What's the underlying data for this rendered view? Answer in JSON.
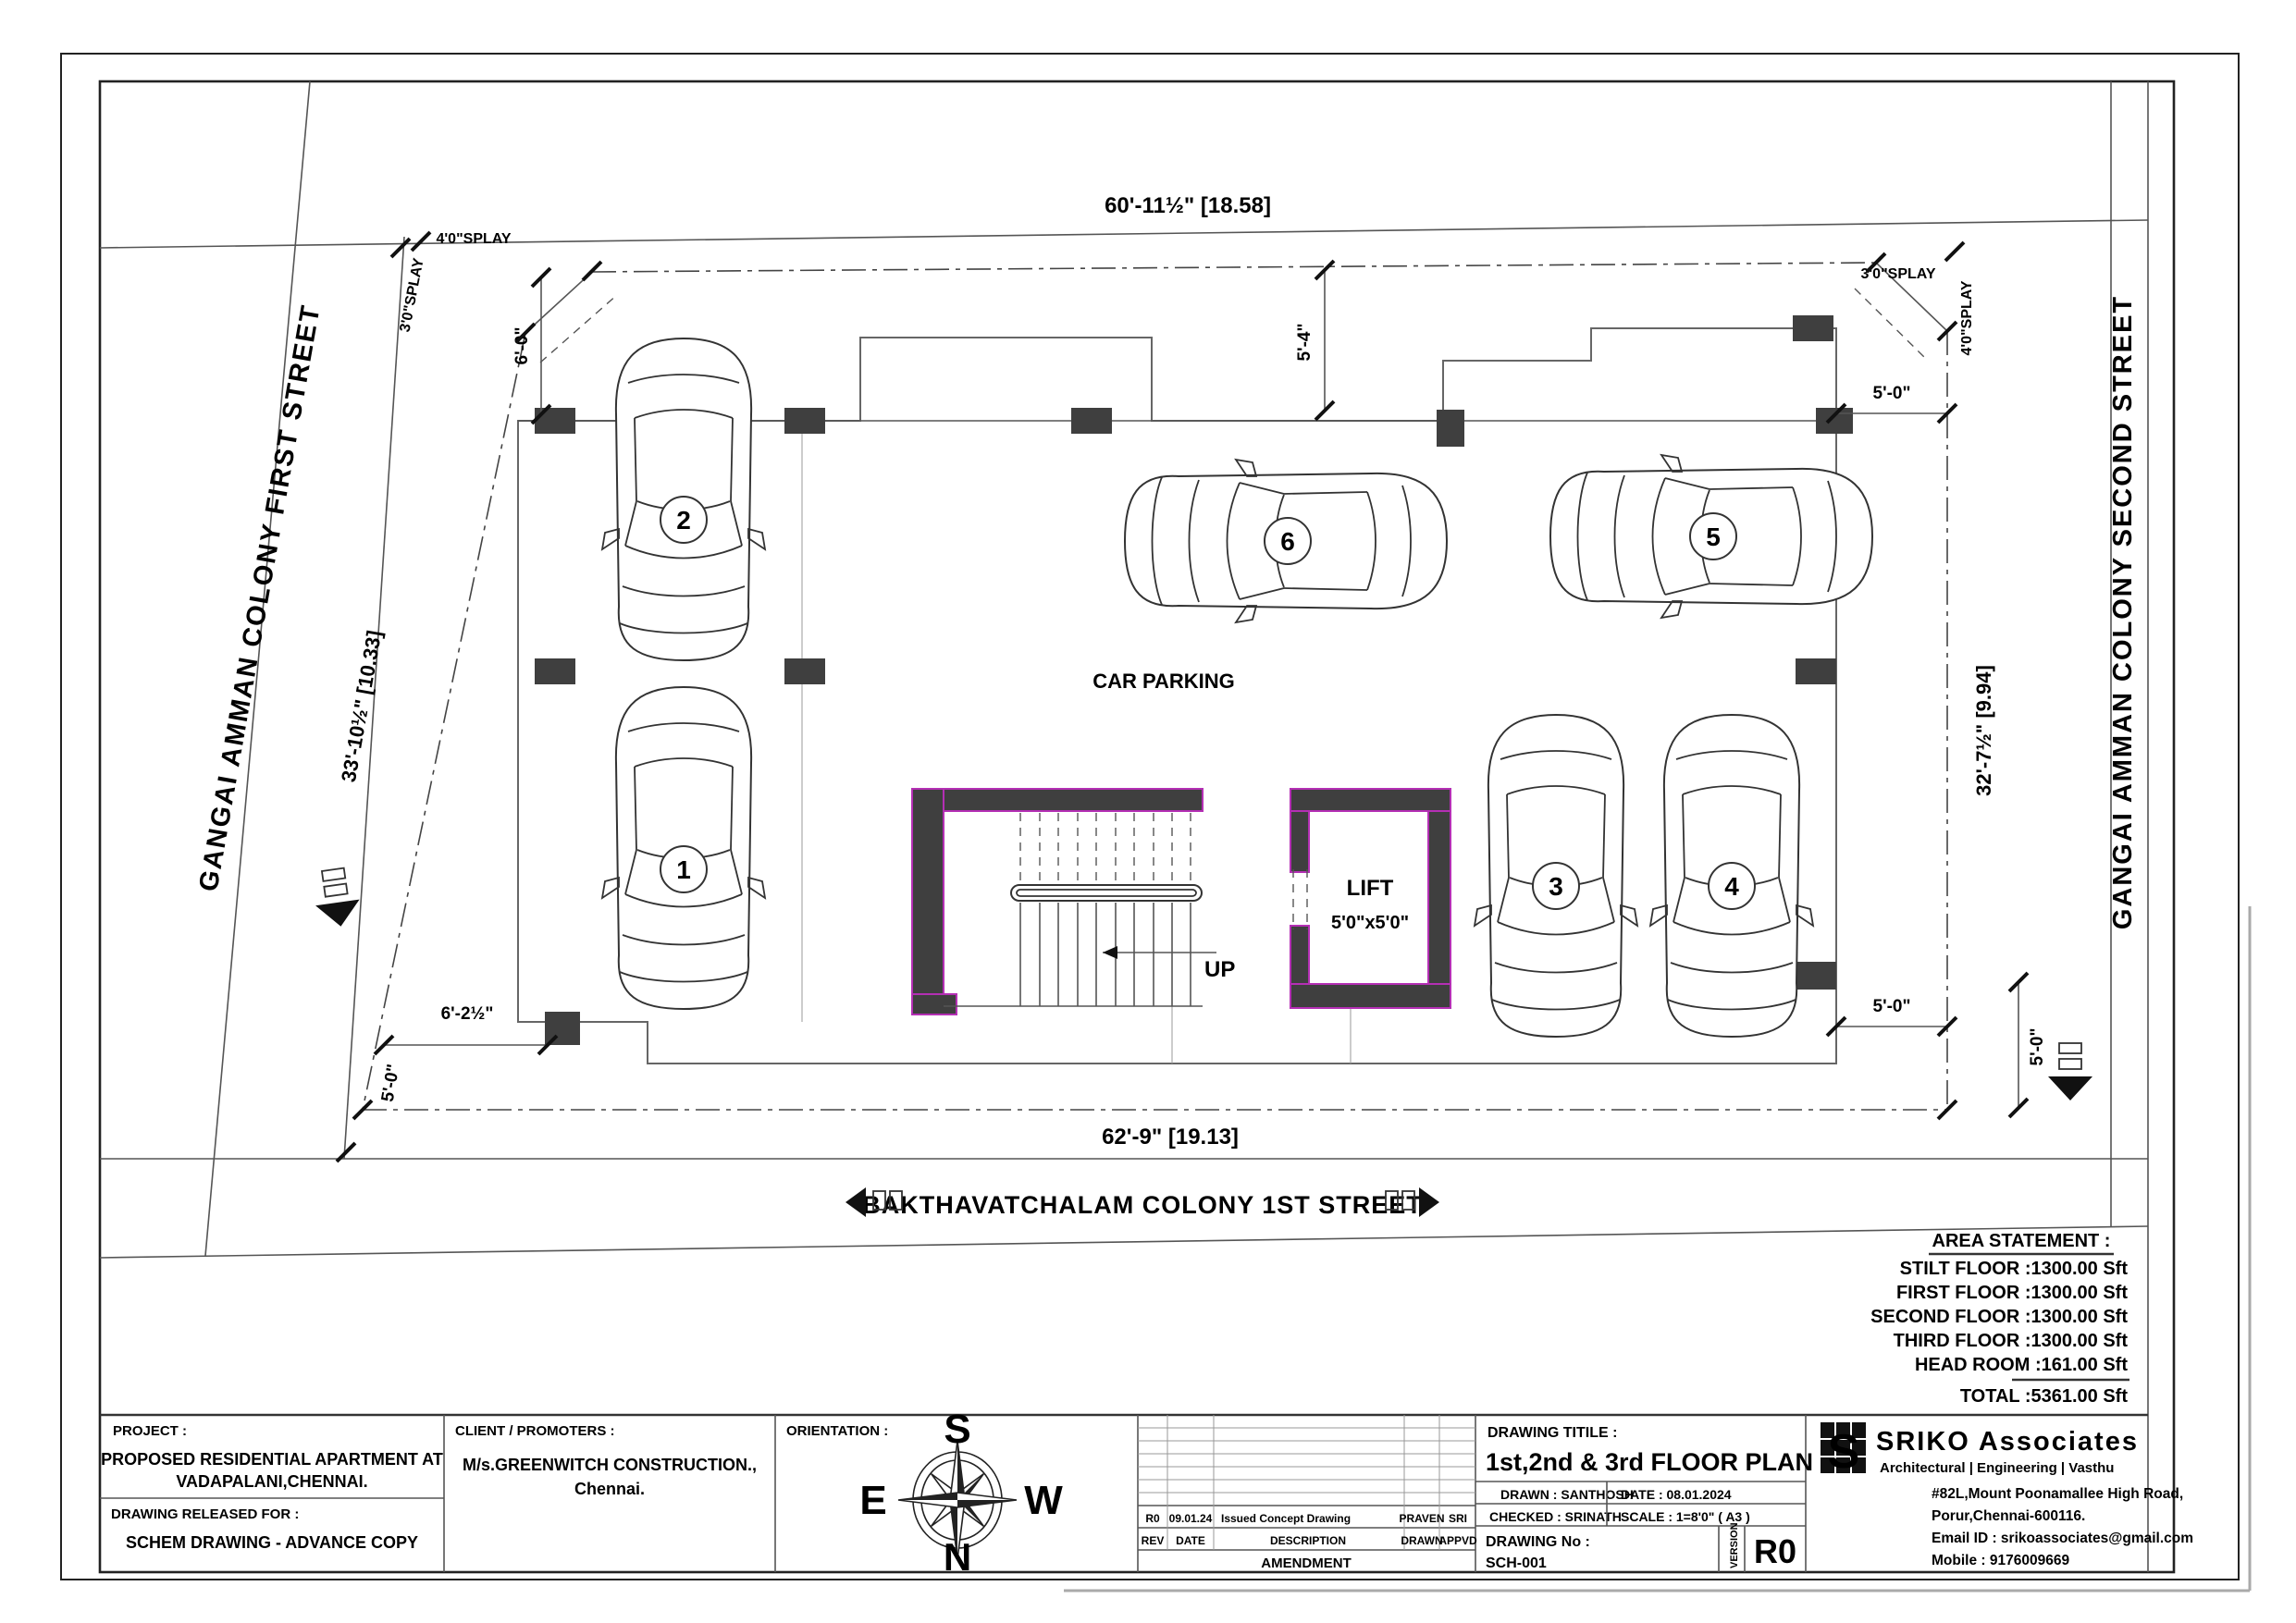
{
  "colors": {
    "wall": "#3f3f3f",
    "accent": "#b42fb4"
  },
  "plan": {
    "dim_top": "60'-11½\" [18.58]",
    "dim_bottom": "62'-9\" [19.13]",
    "dim_left": "33'-10½\" [10.33]",
    "dim_right": "32'-7½\" [9.94]",
    "dim_6_0": "6'-0\"",
    "dim_5_4": "5'-4\"",
    "dim_5_0": "5'-0\"",
    "dim_6_2h": "6'-2½\"",
    "splay_3_0": "3'0\"SPLAY",
    "splay_4_0": "4'0\"SPLAY",
    "street_left": "GANGAI AMMAN  COLONY FIRST STREET",
    "street_right": "GANGAI AMMAN  COLONY SECOND STREET",
    "street_bottom": "BAKTHAVATCHALAM  COLONY 1ST STREET",
    "car_parking": "CAR PARKING",
    "up": "UP",
    "lift_label": "LIFT",
    "lift_size": "5'0\"x5'0\"",
    "cars": [
      "1",
      "2",
      "3",
      "4",
      "5",
      "6"
    ]
  },
  "area": {
    "title": "AREA STATEMENT :",
    "rows": [
      "STILT FLOOR :1300.00 Sft",
      "FIRST FLOOR :1300.00 Sft",
      "SECOND FLOOR :1300.00 Sft",
      "THIRD FLOOR :1300.00 Sft",
      "HEAD ROOM :161.00 Sft"
    ],
    "total": "TOTAL :5361.00 Sft"
  },
  "title_block": {
    "project_label": "PROJECT :",
    "project_line1": "PROPOSED RESIDENTIAL APARTMENT AT",
    "project_line2": "VADAPALANI,CHENNAI.",
    "released_label": "DRAWING RELEASED FOR :",
    "released_value": "SCHEM DRAWING - ADVANCE COPY",
    "client_label": "CLIENT / PROMOTERS :",
    "client_line1": "M/s.GREENWITCH CONSTRUCTION.,",
    "client_line2": "Chennai.",
    "orientation_label": "ORIENTATION :",
    "compass": {
      "n": "N",
      "s": "S",
      "e": "E",
      "w": "W"
    },
    "amendment": {
      "row_rev": "R0",
      "row_date": "09.01.24",
      "row_desc": "Issued Concept Drawing",
      "row_drawn": "PRAVEN",
      "row_appvd": "SRI",
      "hdr_rev": "REV",
      "hdr_date": "DATE",
      "hdr_desc": "DESCRIPTION",
      "hdr_drawn": "DRAWN",
      "hdr_appvd": "APPVD",
      "footer": "AMENDMENT"
    },
    "title_label": "DRAWING TITILE :",
    "title_value": "1st,2nd & 3rd FLOOR PLAN",
    "drawn": "DRAWN  : SANTHOSH",
    "date": "DATE :  08.01.2024",
    "checked": "CHECKED  : SRINATH",
    "scale": "SCALE :  1=8'0\" ( A3 )",
    "drawing_no_label": "DRAWING No :",
    "drawing_no": "SCH-001",
    "version_label": "VERSION",
    "version": "R0",
    "firm": {
      "logo_letter": "S",
      "name": "SRIKO Associates",
      "tagline": "Architectural | Engineering | Vasthu",
      "addr1": "#82L,Mount Poonamallee High Road,",
      "addr2": "Porur,Chennai-600116.",
      "addr3": "Email ID : srikoassociates@gmail.com",
      "addr4": "Mobile    : 9176009669"
    }
  }
}
